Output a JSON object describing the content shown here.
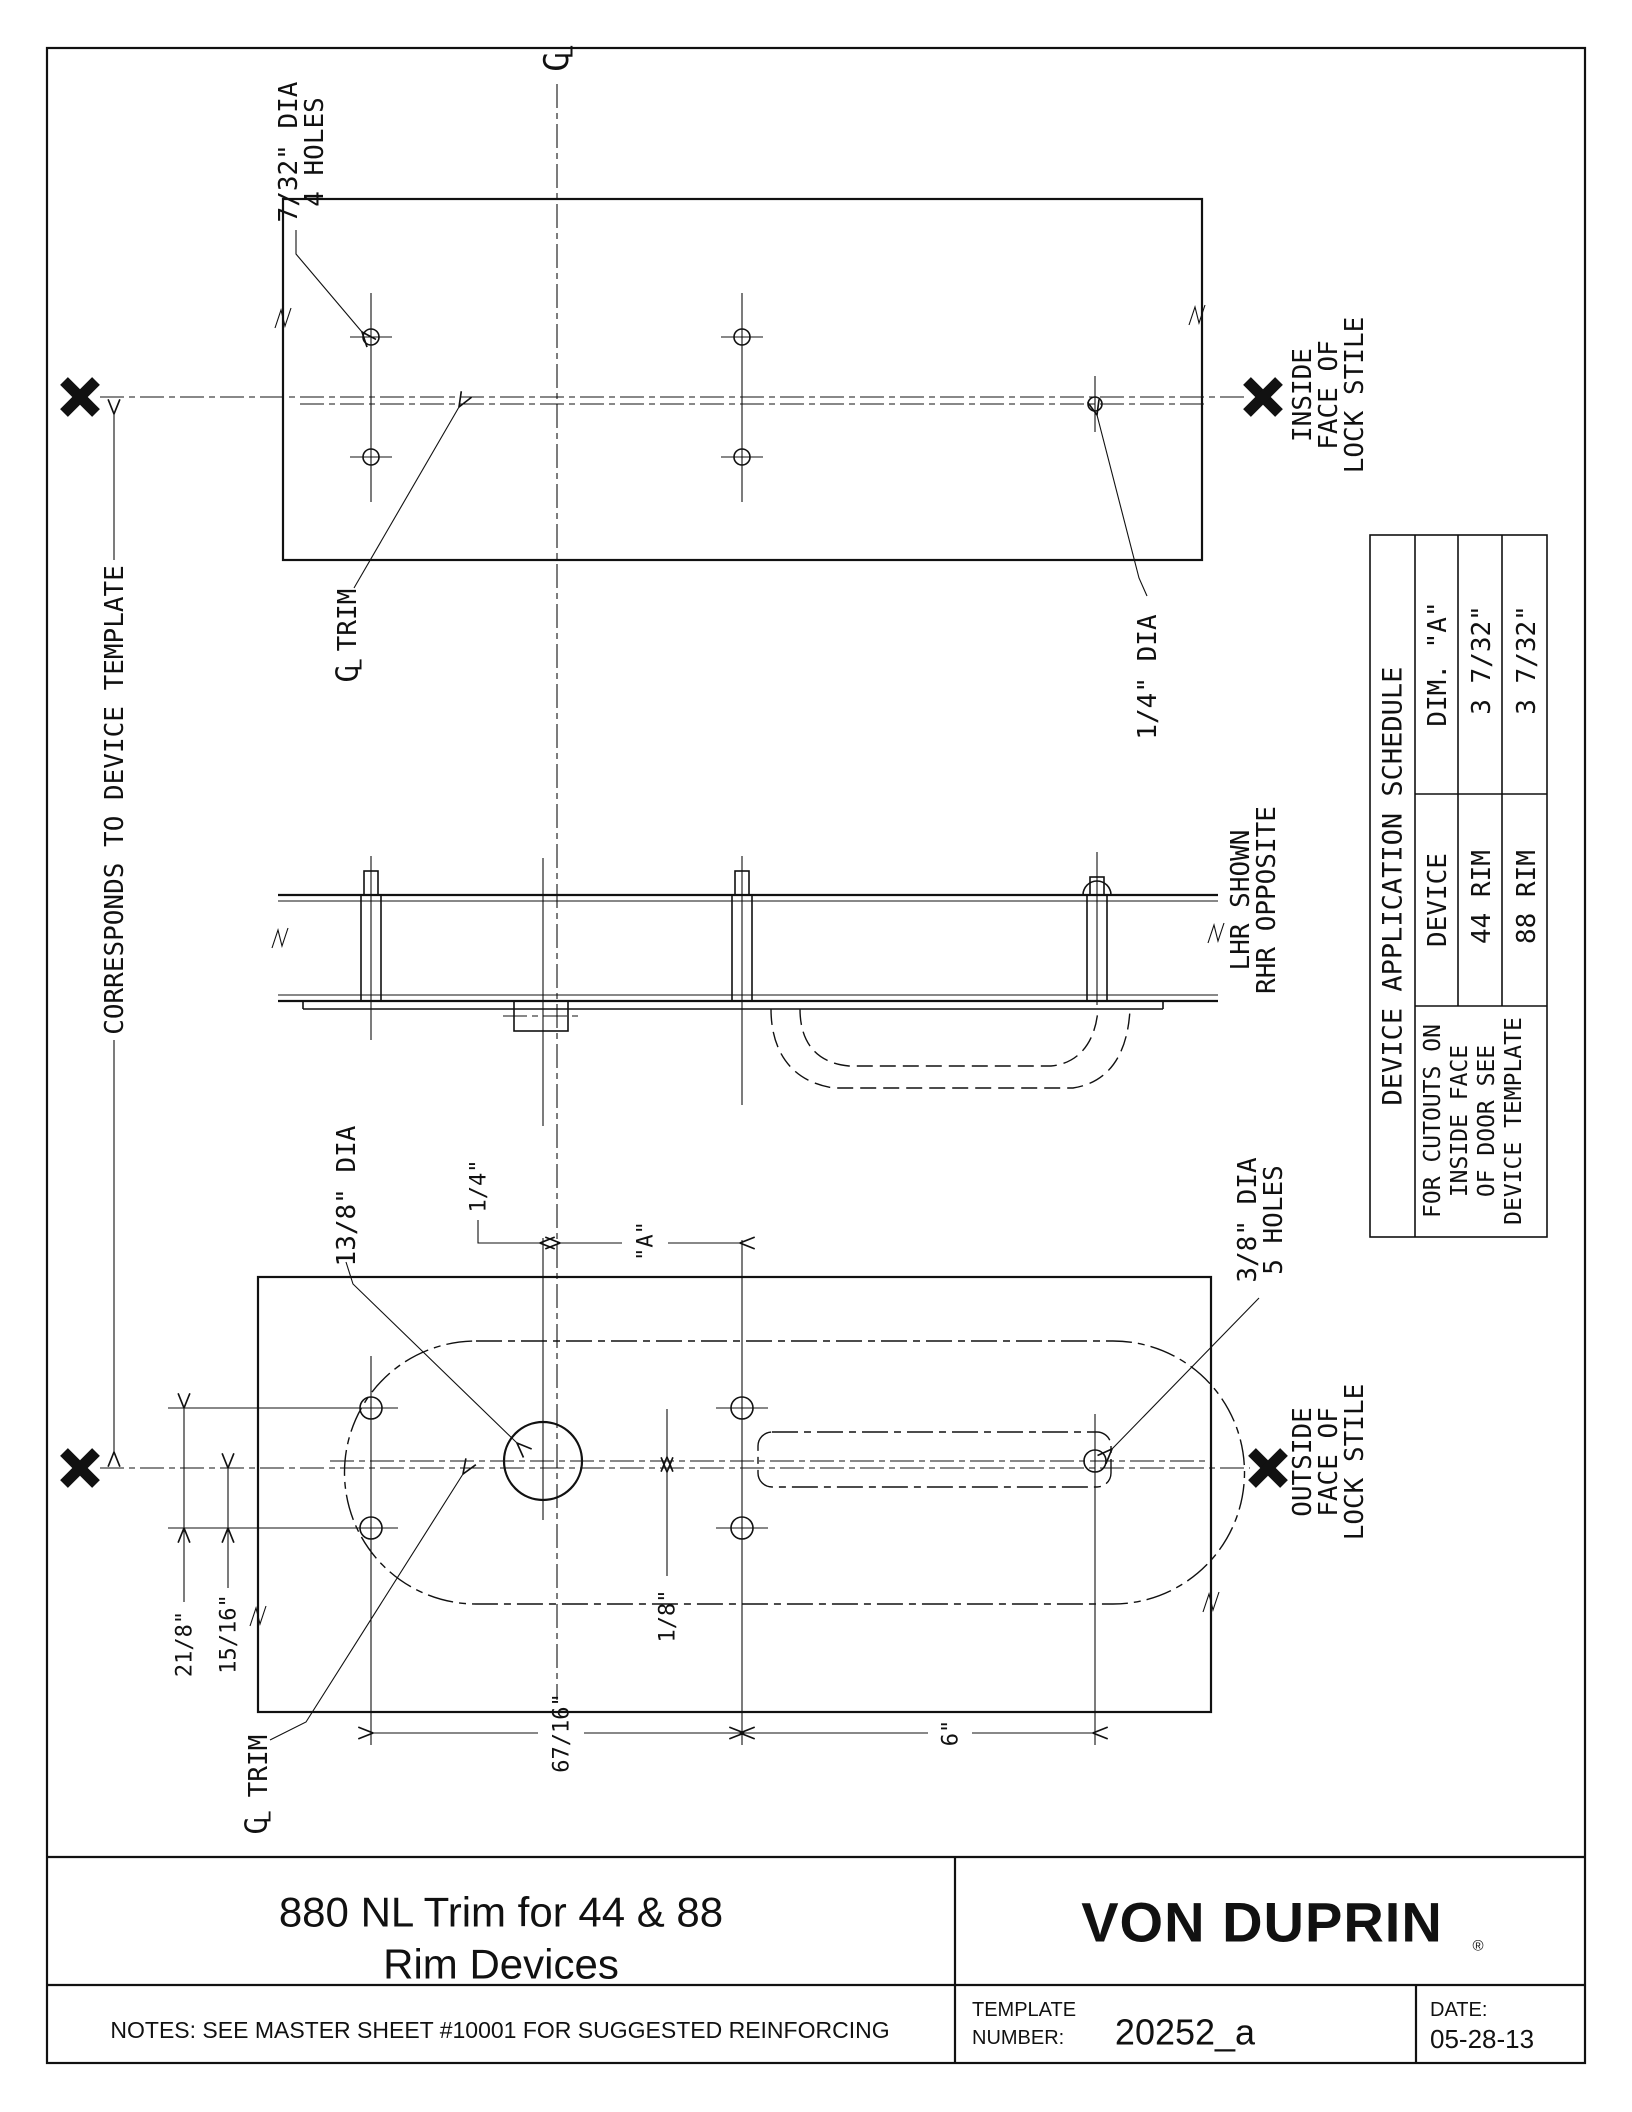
{
  "views": {
    "cl_c": "C",
    "cl_l": "L",
    "note_vertical": "CORRESPONDS TO DEVICE TEMPLATE",
    "top": {
      "hole_label_1": "7/32\" DIA",
      "hole_label_2": "4 HOLES",
      "trim_label": "TRIM",
      "dia_label": "1/4\" DIA",
      "face_1": "INSIDE",
      "face_2": "FACE OF",
      "face_3": "LOCK STILE"
    },
    "middle": {
      "hand_1": "LHR SHOWN",
      "hand_2": "RHR OPPOSITE"
    },
    "bottom": {
      "big_hole_label": "13/8\" DIA",
      "dim_quarter": "1/4\"",
      "dim_a": "\"A\"",
      "dim_eighth": "1/8\"",
      "dim_2_1_8": "21/8\"",
      "dim_15_16": "15/16\"",
      "dim_6_7_16": "67/16\"",
      "dim_6": "6\"",
      "holes_label_1": "3/8\" DIA",
      "holes_label_2": "5 HOLES",
      "trim_label": "TRIM",
      "face_1": "OUTSIDE",
      "face_2": "FACE OF",
      "face_3": "LOCK STILE"
    }
  },
  "schedule": {
    "title": "DEVICE APPLICATION SCHEDULE",
    "col_device": "DEVICE",
    "col_dim": "DIM. \"A\"",
    "rows": [
      {
        "device": "44 RIM",
        "dim": "3 7/32\""
      },
      {
        "device": "88 RIM",
        "dim": "3 7/32\""
      }
    ],
    "note_lines": [
      "FOR CUTOUTS ON",
      "INSIDE FACE",
      "OF DOOR SEE",
      "DEVICE TEMPLATE"
    ]
  },
  "title_block": {
    "title_line1": "880 NL Trim for 44 & 88",
    "title_line2": "Rim Devices",
    "brand": "VON DUPRIN",
    "registered": "®",
    "notes": "NOTES: SEE MASTER SHEET #10001 FOR SUGGESTED REINFORCING",
    "template_label_1": "TEMPLATE",
    "template_label_2": "NUMBER:",
    "template_number": "20252_a",
    "date_label": "DATE:",
    "date_value": "05-28-13"
  }
}
